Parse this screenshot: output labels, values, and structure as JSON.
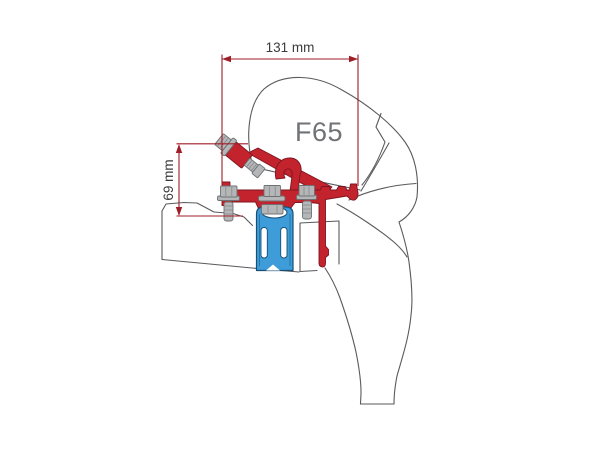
{
  "diagram": {
    "product_label": "F65",
    "dimension_width_label": "131 mm",
    "dimension_height_label": "69 mm",
    "colors": {
      "bracket_red": "#C2232C",
      "clamp_blue": "#3E9CD8",
      "clamp_blue_dark": "#174F76",
      "dimension_red": "#9F1D27",
      "outline_gray": "#595A5D",
      "hardware_gray": "#B4B6B8",
      "product_label_gray": "#717275",
      "dimension_text_gray": "#3B3B3D",
      "background": "#FFFFFF"
    }
  }
}
